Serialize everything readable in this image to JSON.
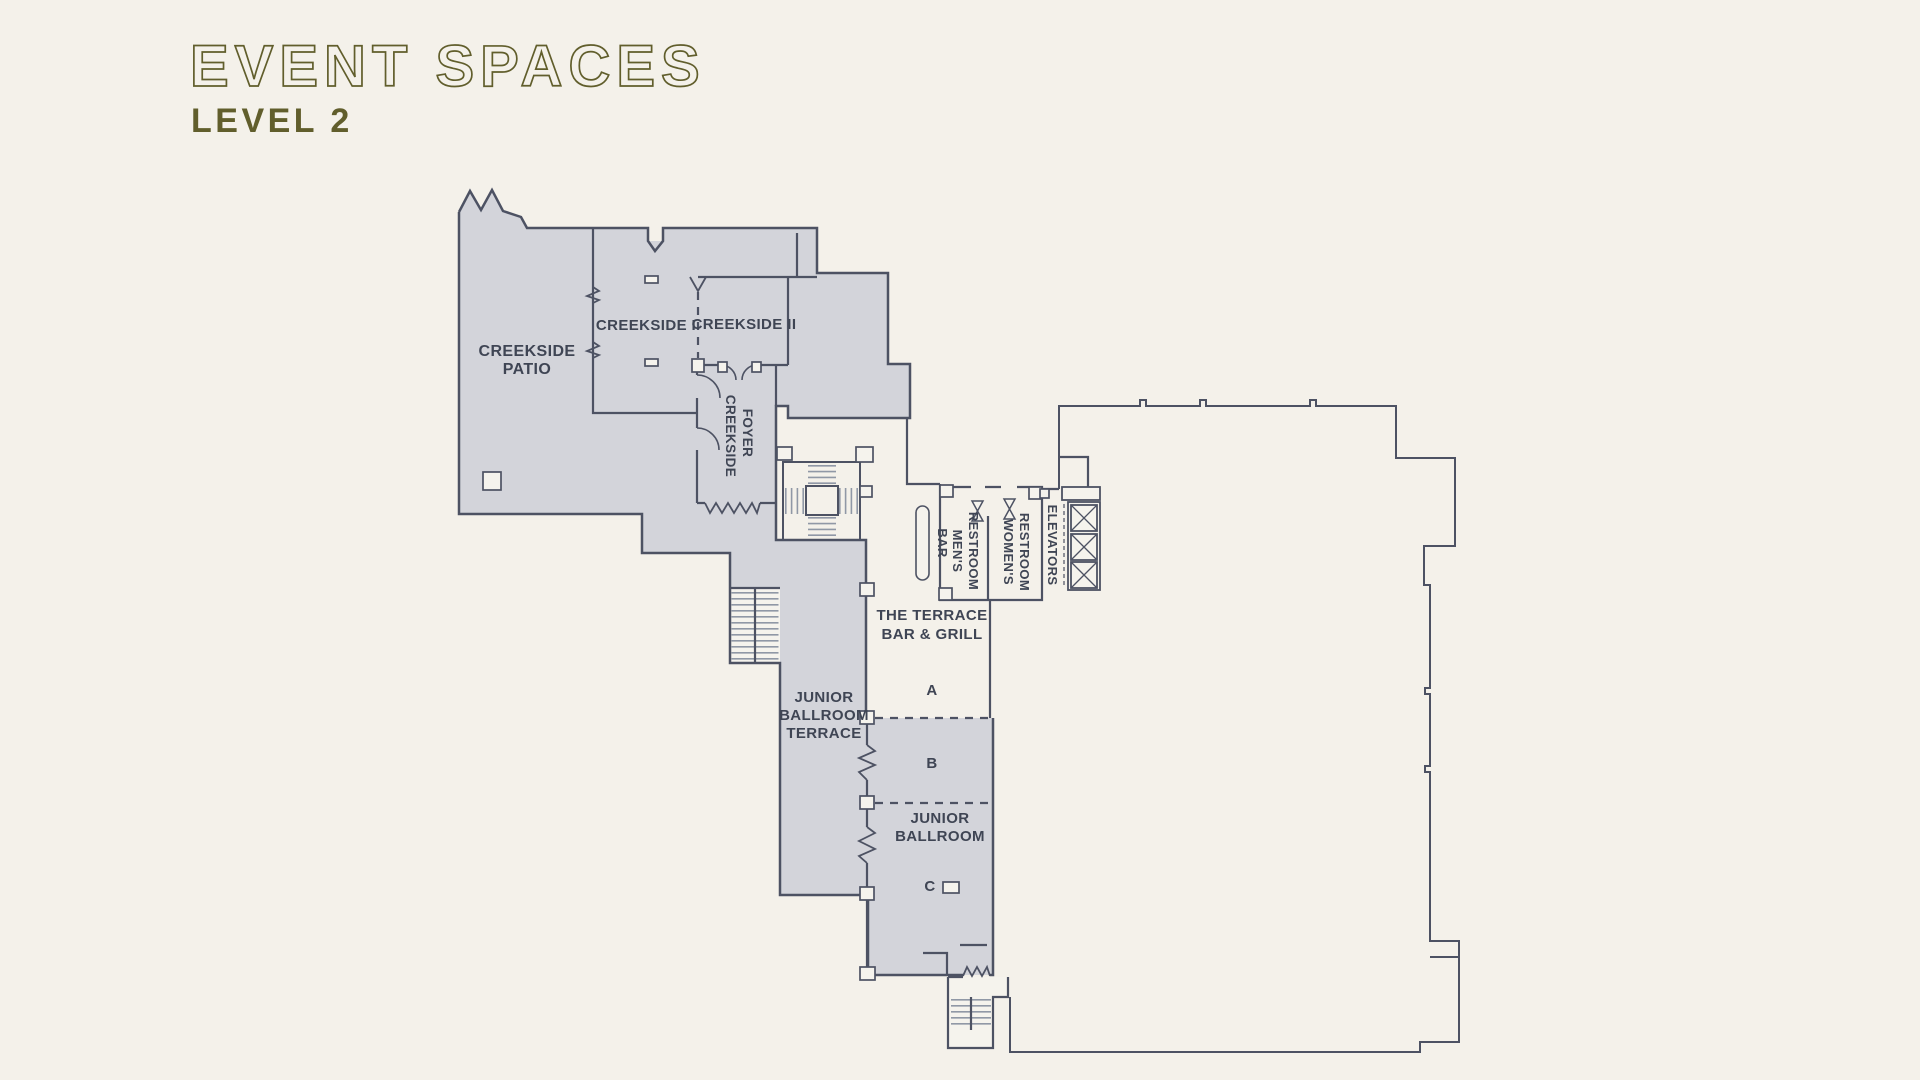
{
  "header": {
    "title": "EVENT SPACES",
    "subtitle": "LEVEL 2"
  },
  "colors": {
    "background": "#f4f1ea",
    "shaded_room_fill": "#d3d4da",
    "wall": "#4d5263",
    "label_text": "#3f4554",
    "title_olive": "#615e2c",
    "unshaded_room_fill": "#f5f3ed"
  },
  "rooms": {
    "creekside_patio": {
      "lines": [
        "CREEKSIDE",
        "PATIO"
      ]
    },
    "creekside_1": {
      "label": "CREEKSIDE I"
    },
    "creekside_2": {
      "label": "CREEKSIDE II"
    },
    "creekside_foyer": {
      "lines": [
        "CREEKSIDE",
        "FOYER"
      ]
    },
    "bar": {
      "label": "BAR"
    },
    "mens_restroom": {
      "lines": [
        "MEN'S",
        "RESTROOM"
      ]
    },
    "womens_restroom": {
      "lines": [
        "WOMEN'S",
        "RESTROOM"
      ]
    },
    "elevators": {
      "label": "ELEVATORS"
    },
    "terrace_bar_grill": {
      "lines": [
        "THE TERRACE",
        "BAR & GRILL"
      ]
    },
    "junior_ballroom_terrace": {
      "lines": [
        "JUNIOR",
        "BALLROOM",
        "TERRACE"
      ]
    },
    "junior_ballroom": {
      "lines": [
        "JUNIOR",
        "BALLROOM"
      ]
    },
    "sections": {
      "a": "A",
      "b": "B",
      "c": "C"
    }
  }
}
